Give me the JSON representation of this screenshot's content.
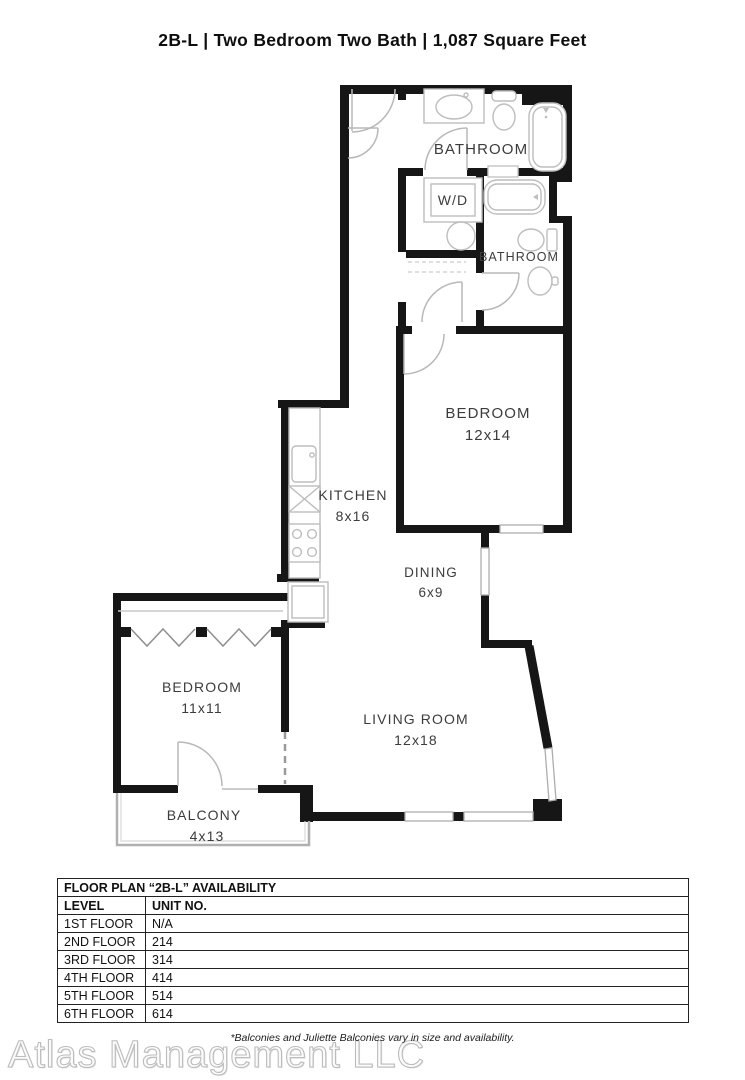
{
  "header": {
    "title": "2B-L | Two Bedroom Two Bath | 1,087 Square Feet"
  },
  "floor_plan": {
    "labels": {
      "bathroom_main": "BATHROOM",
      "washer_dryer": "W/D",
      "bathroom_second": "BATHROOM",
      "bedroom_main": {
        "name": "BEDROOM",
        "dims": "12x14"
      },
      "kitchen": {
        "name": "KITCHEN",
        "dims": "8x16"
      },
      "dining": {
        "name": "DINING",
        "dims": "6x9"
      },
      "bedroom_second": {
        "name": "BEDROOM",
        "dims": "11x11"
      },
      "living_room": {
        "name": "LIVING ROOM",
        "dims": "12x18"
      },
      "balcony": {
        "name": "BALCONY",
        "dims": "4x13"
      }
    }
  },
  "availability_table": {
    "title": "FLOOR PLAN “2B-L” AVAILABILITY",
    "columns": [
      "LEVEL",
      "UNIT NO."
    ],
    "rows": [
      [
        "1ST FLOOR",
        "N/A"
      ],
      [
        "2ND FLOOR",
        "214"
      ],
      [
        "3RD FLOOR",
        "314"
      ],
      [
        "4TH FLOOR",
        "414"
      ],
      [
        "5TH FLOOR",
        "514"
      ],
      [
        "6TH FLOOR",
        "614"
      ]
    ]
  },
  "footer": {
    "watermark": "Atlas Management LLC",
    "note": "*Balconies and Juliette Balconies vary in size and availability."
  },
  "colors": {
    "wall": "#161616",
    "fixture_line": "#bdbdbd",
    "label_text": "#3c3c3c",
    "table_border": "#222222",
    "watermark_outline": "#bcbcbc"
  }
}
